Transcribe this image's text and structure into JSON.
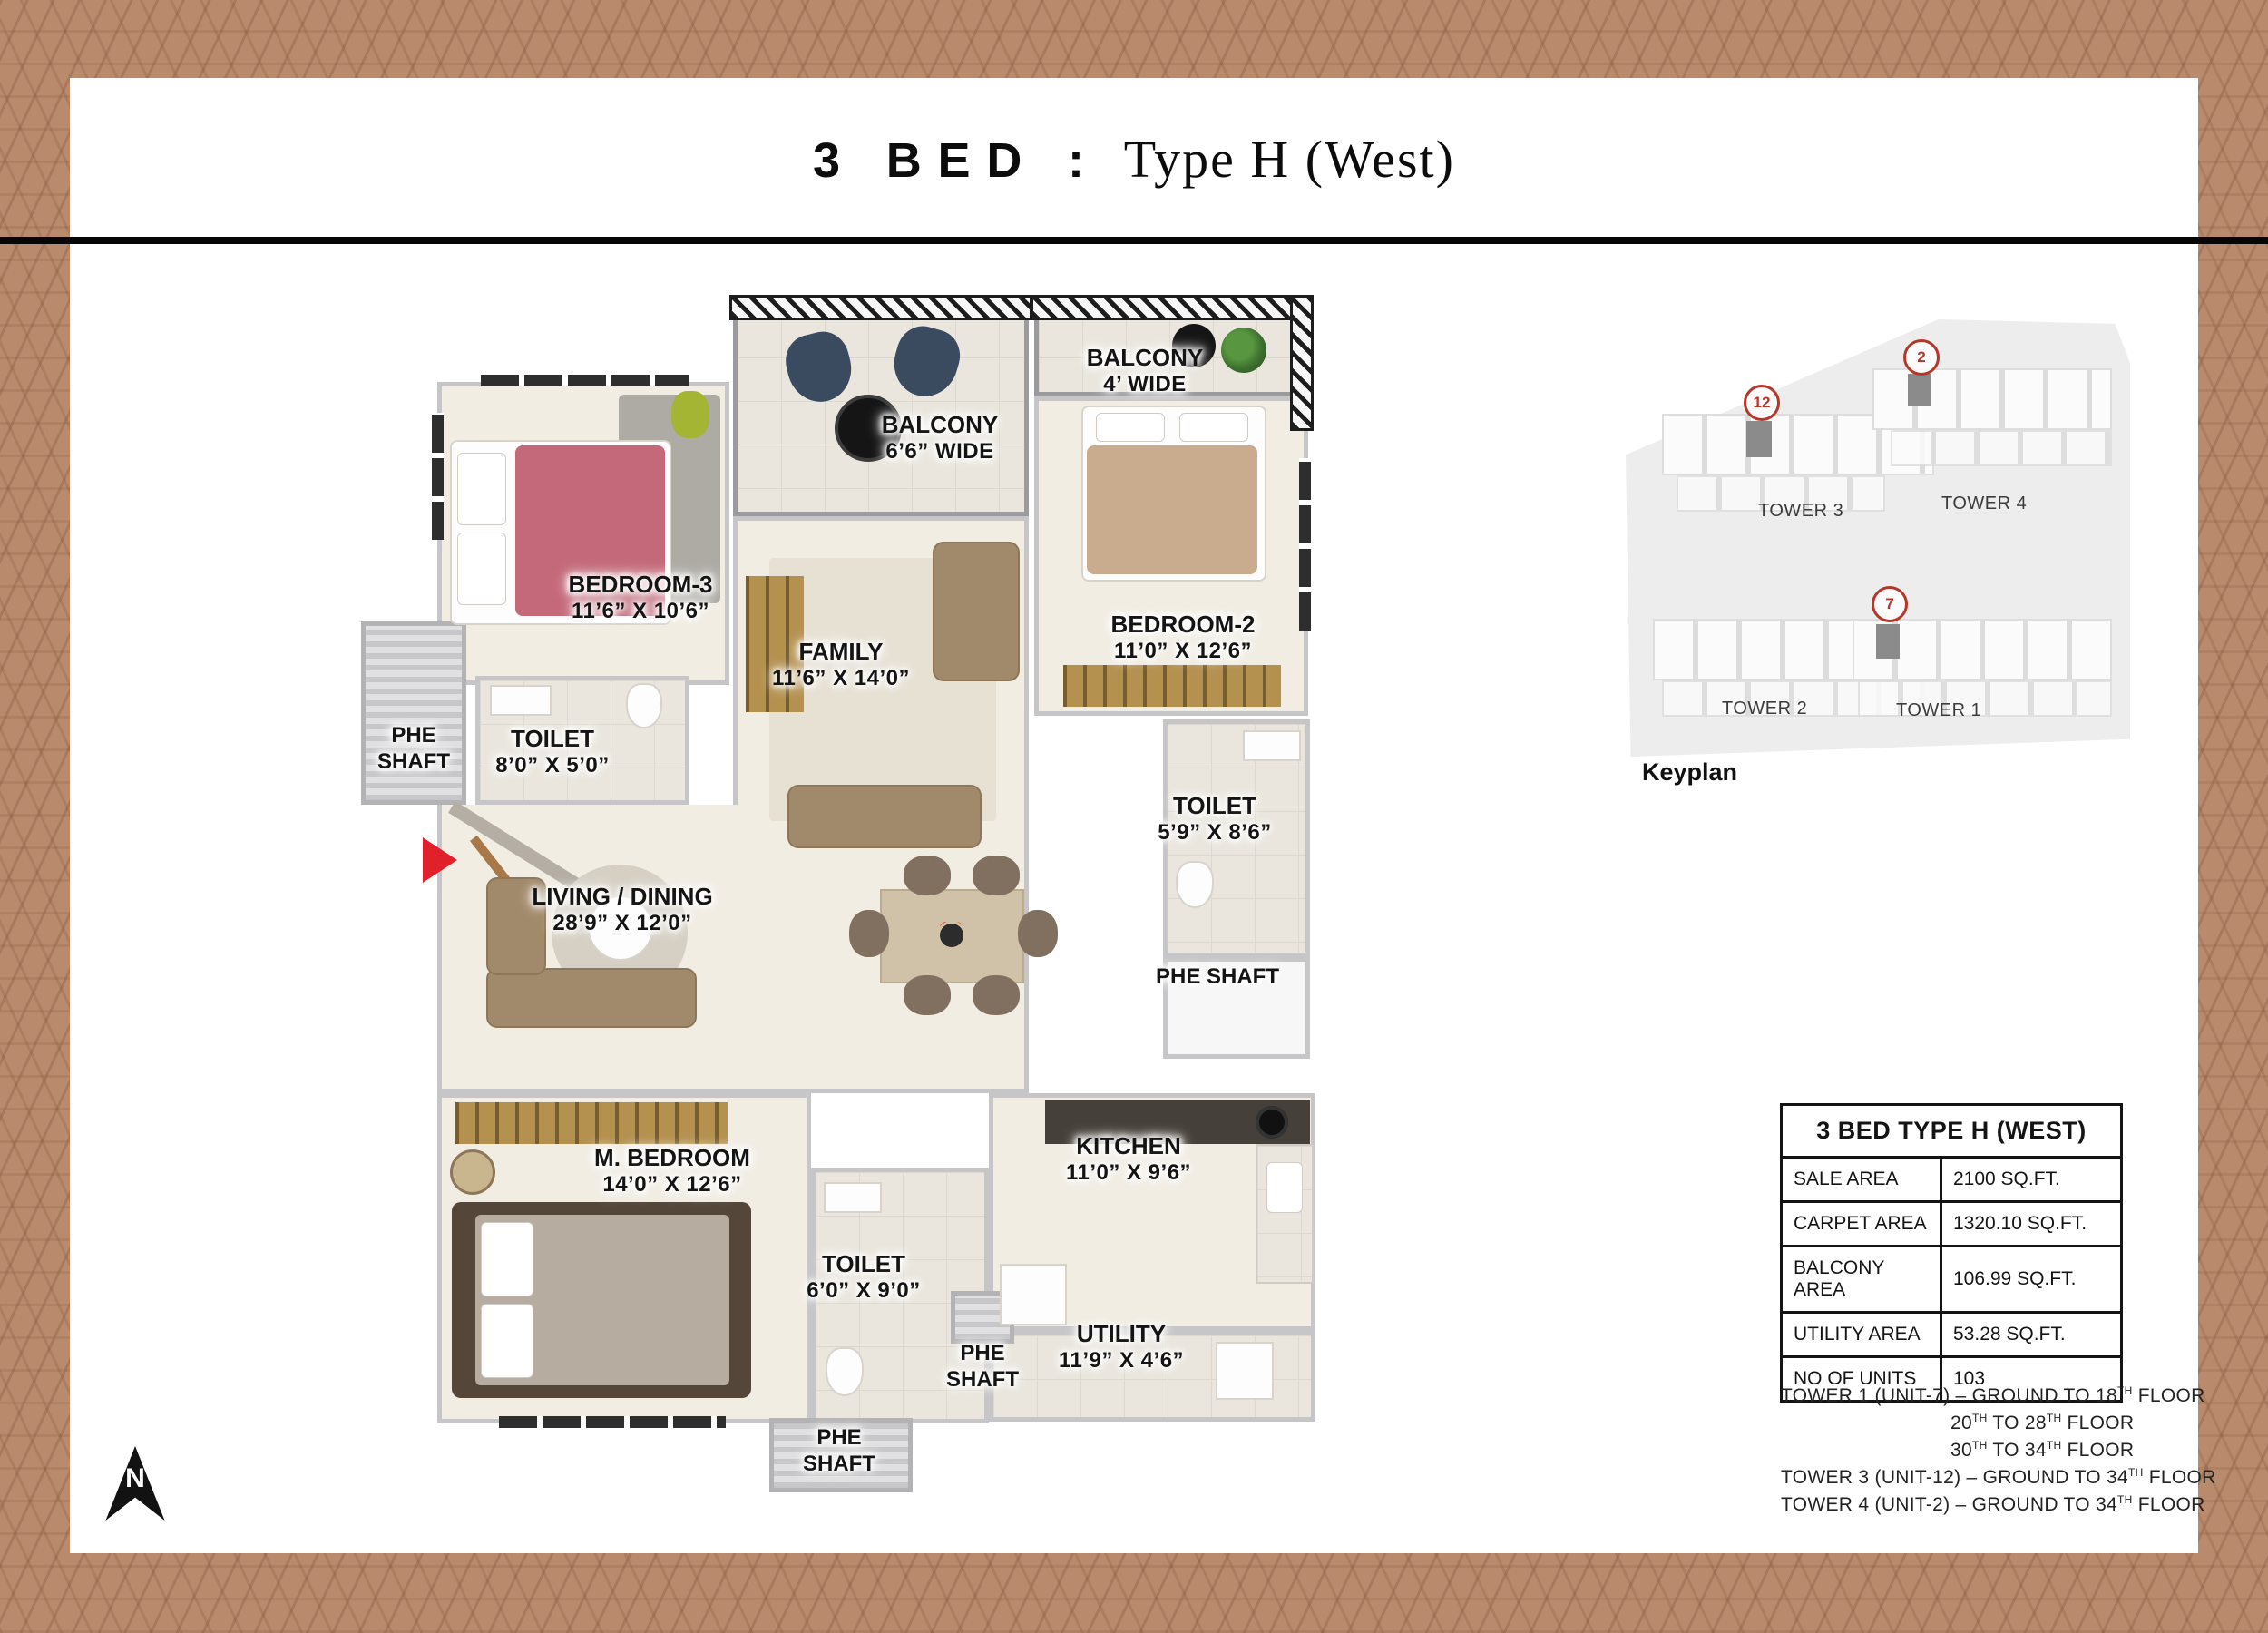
{
  "title": {
    "bold": "3 BED :",
    "serif": "Type H (West)"
  },
  "colors": {
    "background": "#b98a6c",
    "pattern_line": "#7d4e32",
    "accent_red": "#e0202a",
    "marker_red": "#b5372a",
    "highlight_unit": "#8b8b8b"
  },
  "floorplan": {
    "north_label": "N",
    "rooms": {
      "balcony4": {
        "name": "BALCONY",
        "dims": "4’ WIDE"
      },
      "balcony66": {
        "name": "BALCONY",
        "dims": "6’6” WIDE"
      },
      "bedroom3": {
        "name": "BEDROOM-3",
        "dims": "11’6” X 10’6”"
      },
      "family": {
        "name": "FAMILY",
        "dims": "11’6” X 14’0”"
      },
      "bedroom2": {
        "name": "BEDROOM-2",
        "dims": "11’0” X 12’6”"
      },
      "phe_left": {
        "name": "PHE SHAFT"
      },
      "toilet_b3": {
        "name": "TOILET",
        "dims": "8’0” X 5’0”"
      },
      "living": {
        "name": "LIVING / DINING",
        "dims": "28’9” X 12’0”"
      },
      "toilet_b2": {
        "name": "TOILET",
        "dims": "5’9” X 8’6”"
      },
      "phe_right": {
        "name": "PHE SHAFT"
      },
      "mbedroom": {
        "name": "M. BEDROOM",
        "dims": "14’0” X 12’6”"
      },
      "kitchen": {
        "name": "KITCHEN",
        "dims": "11’0” X 9’6”"
      },
      "toilet_m": {
        "name": "TOILET",
        "dims": "6’0” X 9’0”"
      },
      "utility": {
        "name": "UTILITY",
        "dims": "11’9” X 4’6”"
      },
      "phe_center": {
        "name": "PHE SHAFT"
      },
      "phe_bottom": {
        "name": "PHE SHAFT"
      }
    }
  },
  "keyplan": {
    "caption": "Keyplan",
    "tower_labels": [
      "TOWER 3",
      "TOWER 4",
      "TOWER 2",
      "TOWER 1"
    ],
    "unit_markers": [
      {
        "num": "12"
      },
      {
        "num": "2"
      },
      {
        "num": "7"
      }
    ]
  },
  "area_table": {
    "title": "3 BED TYPE H (WEST)",
    "rows": [
      {
        "label": "SALE AREA",
        "value": "2100 SQ.FT."
      },
      {
        "label": "CARPET AREA",
        "value": "1320.10 SQ.FT."
      },
      {
        "label": "BALCONY AREA",
        "value": "106.99 SQ.FT."
      },
      {
        "label": "UTILITY AREA",
        "value": "53.28 SQ.FT."
      },
      {
        "label": "NO OF UNITS",
        "value": "103"
      }
    ]
  },
  "notes": [
    {
      "indent": false,
      "segs": [
        {
          "t": "TOWER 1 (UNIT-7) – GROUND TO 18"
        },
        {
          "t": "TH",
          "sup": true
        },
        {
          "t": " FLOOR"
        }
      ]
    },
    {
      "indent": true,
      "segs": [
        {
          "t": "20"
        },
        {
          "t": "TH",
          "sup": true
        },
        {
          "t": " TO 28"
        },
        {
          "t": "TH",
          "sup": true
        },
        {
          "t": " FLOOR"
        }
      ]
    },
    {
      "indent": true,
      "segs": [
        {
          "t": "30"
        },
        {
          "t": "TH",
          "sup": true
        },
        {
          "t": " TO 34"
        },
        {
          "t": "TH",
          "sup": true
        },
        {
          "t": " FLOOR"
        }
      ]
    },
    {
      "indent": false,
      "segs": [
        {
          "t": "TOWER 3 (UNIT-12) – GROUND TO 34"
        },
        {
          "t": "TH",
          "sup": true
        },
        {
          "t": " FLOOR"
        }
      ]
    },
    {
      "indent": false,
      "segs": [
        {
          "t": "TOWER 4 (UNIT-2) – GROUND TO 34"
        },
        {
          "t": "TH",
          "sup": true
        },
        {
          "t": " FLOOR"
        }
      ]
    }
  ]
}
